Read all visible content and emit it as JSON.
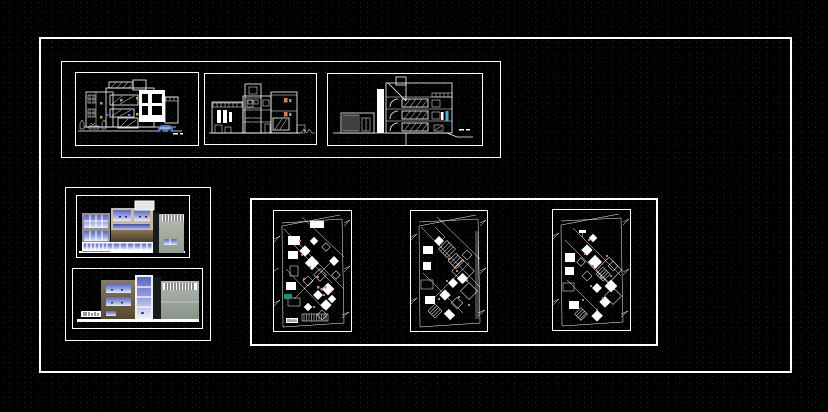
{
  "sheet": {
    "description_label": "",
    "panels": [
      {
        "name": "elevation-front"
      },
      {
        "name": "elevation-side"
      },
      {
        "name": "section-stairs"
      },
      {
        "name": "render-elevation-top"
      },
      {
        "name": "render-elevation-bottom"
      },
      {
        "name": "floor-plan-1"
      },
      {
        "name": "floor-plan-2"
      },
      {
        "name": "floor-plan-3"
      }
    ]
  },
  "colors": {
    "line": "#ffffff",
    "background": "#000000",
    "accent-orange": "#d4824a",
    "accent-yellow": "#b0b038",
    "accent-cyan": "#3fb6d8",
    "accent-teal": "#1f8f7f",
    "accent-pink": "#b98b96",
    "car-blue": "#4a7fc1",
    "wall-gray": "#8f9097",
    "wall-green-gray": "#a9b2a4",
    "wall-beige": "#c9bc96",
    "wall-brown-dark": "#463828",
    "wall-brown-light": "#8a7450",
    "window-blue": "#6b79cf",
    "window-blue-light": "#dfe4f6",
    "dark-strip": "#161b20"
  }
}
